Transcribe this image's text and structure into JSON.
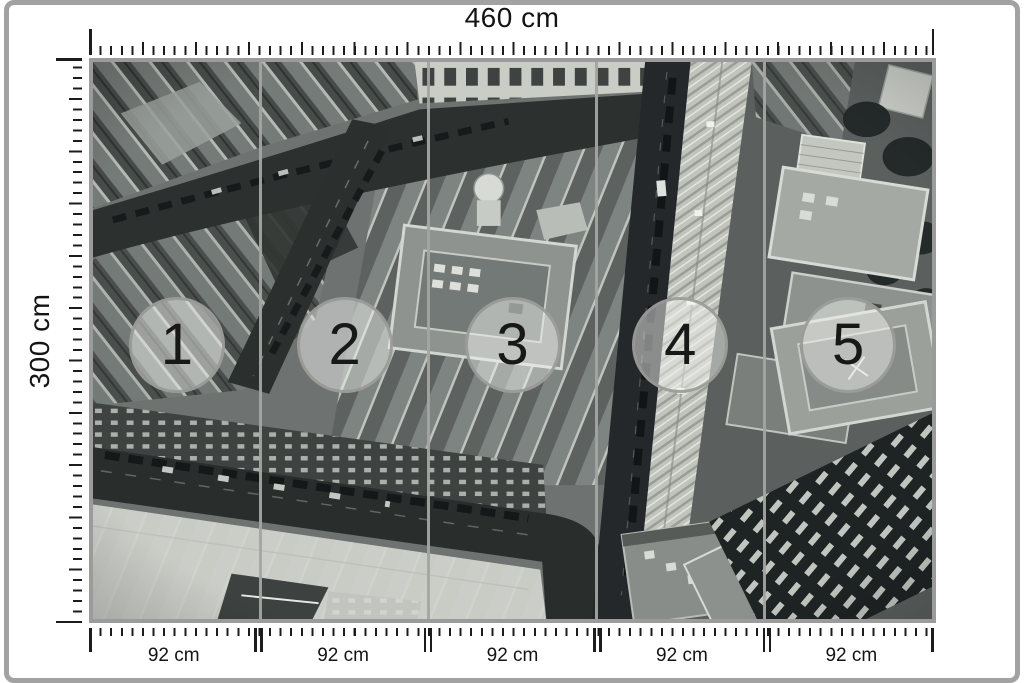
{
  "diagram": {
    "width_label": "460 cm",
    "height_label": "300 cm",
    "photo": {
      "description": "Black and white aerial photograph of dense city blocks with diagonal streets, rooftops and a construction site, split into five vertical wall-mural panels"
    },
    "colors": {
      "frame_gray": "#a2a2a2",
      "mural_border_gray": "#9b9b9b",
      "tick_black": "#1c1c1c",
      "panel_divider_gray": "#a4a4a1",
      "badge_fill": "rgba(240,241,237,0.5)",
      "badge_border": "#98989a"
    }
  },
  "panels": [
    {
      "number": "1",
      "width_label": "92 cm"
    },
    {
      "number": "2",
      "width_label": "92 cm"
    },
    {
      "number": "3",
      "width_label": "92 cm"
    },
    {
      "number": "4",
      "width_label": "92 cm"
    },
    {
      "number": "5",
      "width_label": "92 cm"
    }
  ]
}
